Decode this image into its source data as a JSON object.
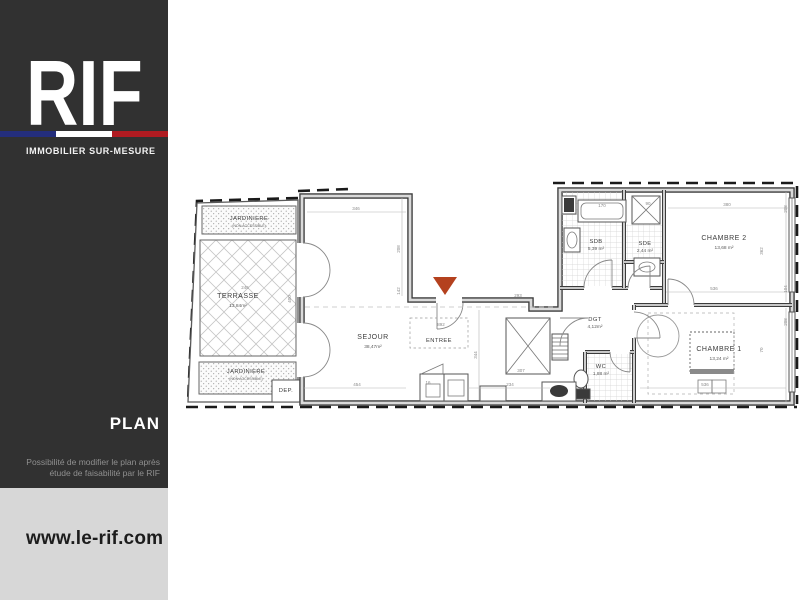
{
  "brand": {
    "logo_text": "RIF",
    "tagline": "IMMOBILIER  SUR-MESURE",
    "flag_blue": "#242e7c",
    "flag_white": "#ffffff",
    "flag_red": "#b01b21"
  },
  "sidebar": {
    "section_label": "PLAN",
    "disclaimer_line1": "Possibilité de modifier le plan après",
    "disclaimer_line2": "étude de faisabilité par le RIF",
    "website": "www.le-rif.com"
  },
  "plan": {
    "entrance_marker_color": "#b4411e",
    "rooms": [
      {
        "name": "JARDINIERE",
        "area": "(NON ACCESSIBLE)"
      },
      {
        "name": "TERRASSE",
        "area": "13,84m²"
      },
      {
        "name": "JARDINIERE",
        "area": "(NON ACCESSIBLE)"
      },
      {
        "name": "SEJOUR",
        "area": "38,47m²"
      },
      {
        "name": "ENTREE",
        "area": ""
      },
      {
        "name": "DEP.",
        "area": ""
      },
      {
        "name": "SDB",
        "area": "5,39 m²"
      },
      {
        "name": "SDE",
        "area": "2,44 m²"
      },
      {
        "name": "CHAMBRE 2",
        "area": "13,68 m²"
      },
      {
        "name": "CHAMBRE 1",
        "area": "13,24 m²"
      },
      {
        "name": "DGT",
        "area": "4,12m²"
      },
      {
        "name": "WC",
        "area": "1,88 m²"
      }
    ],
    "dimensions": [
      "346",
      "380",
      "536",
      "536",
      "454",
      "234",
      "307",
      "16",
      "892",
      "293",
      "208",
      "142",
      "344",
      "400",
      "246",
      "170",
      "90",
      "208",
      "362",
      "104",
      "208",
      "70"
    ]
  }
}
